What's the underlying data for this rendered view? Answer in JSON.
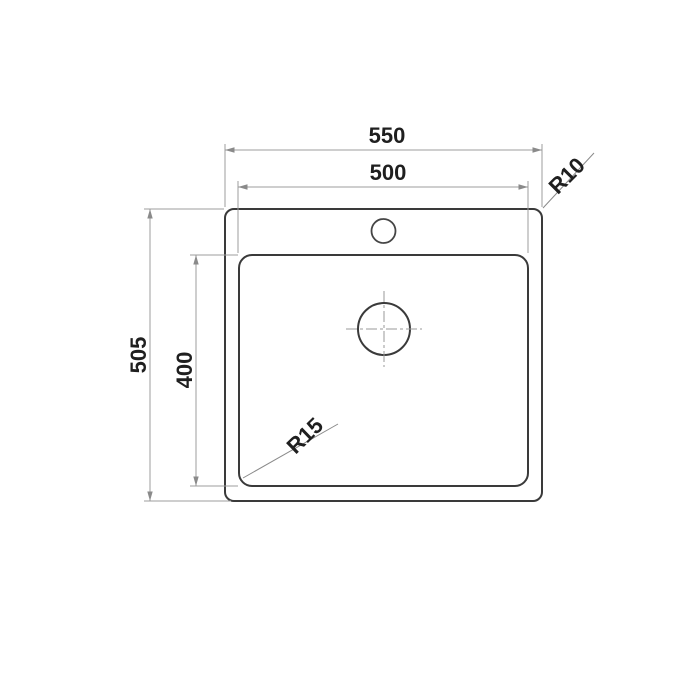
{
  "diagram": {
    "labels": {
      "outer_width": "550",
      "inner_width": "500",
      "outer_height": "505",
      "inner_height": "400",
      "outer_corner_radius": "R10",
      "inner_corner_radius": "R15"
    },
    "colors": {
      "object_line": "#3a3a3a",
      "dimension_line": "#9c9c9c",
      "label_text": "#1f1f1f",
      "background": "#ffffff"
    }
  }
}
